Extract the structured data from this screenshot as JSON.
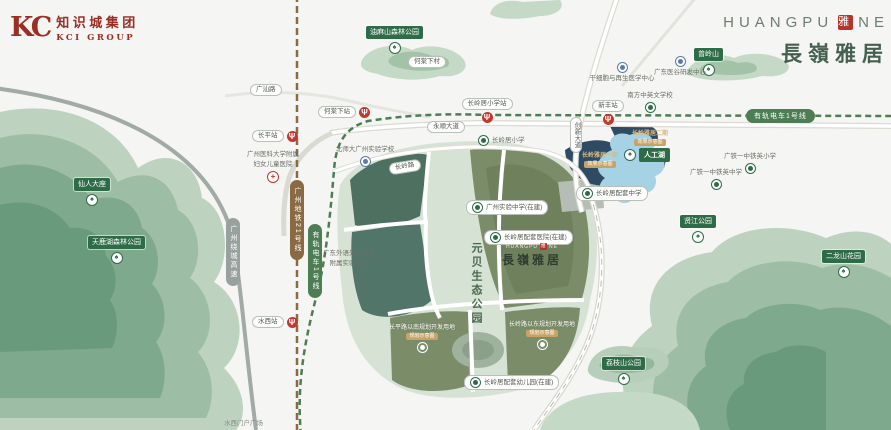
{
  "logo": {
    "mark": "KC",
    "company_cn": "知识城集团",
    "company_en": "KCI GROUP"
  },
  "header": {
    "brand_en": "HUANGPU",
    "seal": "雅",
    "brand_en_suffix": "NE",
    "brand_cn": "長嶺雅居"
  },
  "icons": {
    "metro_glyph": "Ψ",
    "tree_glyph": "♠",
    "cross_glyph": "+"
  },
  "map": {
    "park_title": "元贝生态公园",
    "lake_label": "人工湖",
    "site": {
      "en_prefix": "HUANGPU",
      "seal": "雅",
      "en_suffix": "NE",
      "cn": "長嶺雅居"
    },
    "lines": [
      {
        "label": "广州绕城高速"
      },
      {
        "label": "广州地铁21号线"
      },
      {
        "label": "有轨电车1号线"
      },
      {
        "label": "有轨电车1号线"
      }
    ],
    "stations": [
      {
        "name": "长平站"
      },
      {
        "name": "水西站"
      },
      {
        "name": "何棠下站"
      },
      {
        "name": "长岭居小学站"
      },
      {
        "name": "新丰站"
      }
    ],
    "roads": [
      {
        "name": "广汕路"
      },
      {
        "name": "永顺大道"
      },
      {
        "name": "创新大道"
      },
      {
        "name": "长岭路"
      },
      {
        "name": "何棠下村"
      }
    ],
    "parks": [
      {
        "name": "油麻山森林公园"
      },
      {
        "name": "曾岭山"
      },
      {
        "name": "仙人大座"
      },
      {
        "name": "天鹿湖森林公园"
      },
      {
        "name": "贤江公园"
      },
      {
        "name": "荔枝山公园"
      },
      {
        "name": "二龙山花园"
      }
    ],
    "pois": [
      {
        "name": "广州医科大学附属",
        "name2": "妇女儿童医院"
      },
      {
        "name": "北师大广州实验学校"
      },
      {
        "name": "广东外语外贸大学",
        "name2": "附属实验学校"
      },
      {
        "name": "长岭居小学"
      },
      {
        "name": "南方中英文学校"
      },
      {
        "name": "干细胞与再生医学中心"
      },
      {
        "name": "广东医谷研发中心"
      },
      {
        "name": "广铁一中铁英小学"
      },
      {
        "name": "广铁一中铁英中学"
      },
      {
        "name": "长岭居配套中学"
      },
      {
        "name": "长岭居配套医院(在建)"
      },
      {
        "name": "广州实验中学(在建)"
      },
      {
        "name": "长岭居配套幼儿园(在建)"
      },
      {
        "name": "水西门户广场"
      }
    ],
    "parcels": [
      {
        "label": "长岭雅居一期",
        "tag": "效果示意图"
      },
      {
        "label": "长岭雅居二期",
        "tag": "效果示意图"
      },
      {
        "label": "长平路以南规划开发用地",
        "tag": "规划示意图"
      },
      {
        "label": "长岭路以东规划开发用地",
        "tag": "规划示意图"
      }
    ]
  }
}
